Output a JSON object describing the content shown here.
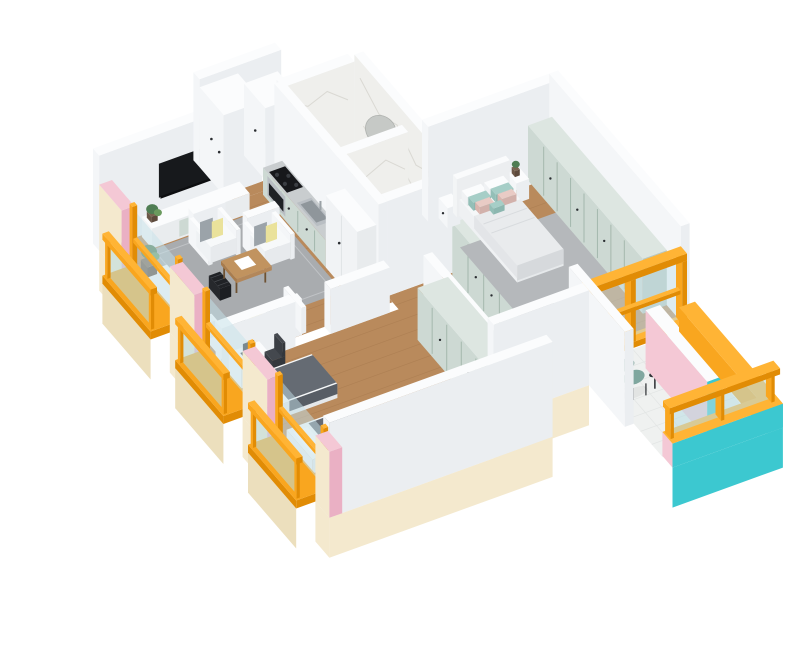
{
  "image_type": "isometric-3d-apartment-floor-plan-render",
  "palette": {
    "white": "#ffffff",
    "wall_top": "#fbfcfd",
    "wall_left": "#f4f6f8",
    "wall_front": "#ebeef1",
    "marble": "#efefec",
    "marble_vein": "#d7d6d0",
    "marble_floor": "#f3f2ef",
    "wood": "#b98a5c",
    "wood_line": "#9c6f45",
    "rug": "#a9acaf",
    "rug_border": "#c0c3c6",
    "cream": "#f4e9ce",
    "cream_dark": "#ecdfbd",
    "pink": "#f4c8d5",
    "pink_dark": "#eab0c4",
    "orange": "#f9a61f",
    "orange_light": "#ffb435",
    "orange_dark": "#e18c05",
    "teal": "#3cc8d0",
    "sage": "#cdd9d3",
    "sage_side": "#b9c8c1",
    "sage_top": "#dde6e1",
    "sage_line": "#a4b8ad",
    "glass": "rgba(197,226,233,0.50)",
    "glass_rail": "rgba(184,220,228,0.55)",
    "tv": "#17191c",
    "dark": "#2a2d31",
    "counter_top": "#c9cdcf",
    "steel": "#b9bec3",
    "steel_dark": "#8f969b",
    "duvet": "#e9ebed",
    "duvet_shade": "#d6d9dc",
    "blanket": "#656b73",
    "blanket_dark": "#575d65",
    "pillow_yellow": "#eae29b",
    "pillow_gray": "#9ba3a9",
    "pillow_teal": "#a6cec7",
    "pillow_teal_side": "#93bfb7",
    "pillow_pink": "#e9cbc5",
    "pillow_pink_side": "#dab5ae",
    "green": "#4f7d53",
    "green_light": "#6a9a5e",
    "pot": "#6b5747",
    "chair_teal": "#7fa79f",
    "chair_teal_dark": "#6e968e",
    "basin_wood": "#c9a377",
    "basin_wood_top": "#d4ad7f",
    "basin_wood_side": "#b98f60"
  },
  "scene": {
    "rooms": [
      {
        "name": "living-room",
        "floor": "wood",
        "furniture": [
          "wall-mounted-tv",
          "tv-stand-with-plants",
          "armchair-1",
          "armchair-2",
          "coffee-table-with-papers",
          "magazine-rack",
          "gray-rug",
          "corner-sofa",
          "floor-plant"
        ]
      },
      {
        "name": "kitchen",
        "floor": "wood",
        "furniture": [
          "sage-base-cabinets",
          "gray-countertop",
          "black-cooktop",
          "oven",
          "steel-sink",
          "tall-white-cabinet"
        ]
      },
      {
        "name": "hallway",
        "floor": "wood",
        "furniture": [
          "white-built-in-wardrobe-1",
          "white-built-in-wardrobe-2"
        ]
      },
      {
        "name": "bathroom-1",
        "floor": "marble",
        "furniture": [
          "washing-machine",
          "round-mirror",
          "wood-vanity-with-basin",
          "black-floor-lamp"
        ]
      },
      {
        "name": "bathroom-2",
        "floor": "marble",
        "furniture": [
          "round-mirror",
          "wood-vanity-with-basin",
          "black-floor-lamp"
        ]
      },
      {
        "name": "corridor",
        "floor": "wood",
        "furniture": [
          "sage-built-in-closet"
        ]
      },
      {
        "name": "master-bedroom",
        "floor": "wood",
        "furniture": [
          "double-bed-white-duvet",
          "headboard",
          "pink-pillows",
          "teal-pillows",
          "nightstand-left",
          "nightstand-right",
          "plant",
          "gray-rug",
          "sage-wardrobe-wall"
        ]
      },
      {
        "name": "second-bedroom",
        "floor": "wood",
        "furniture": [
          "single-bed-1-dark-blanket",
          "single-bed-2-dark-blanket",
          "desk-with-laptop",
          "dark-chair",
          "sage-wardrobe"
        ]
      },
      {
        "name": "left-balconies",
        "floor": "orange-decks",
        "furniture": [
          "glass-railings-orange-handrails",
          "orange-window-frames",
          "cream-facade",
          "pink-wall-cuts"
        ]
      },
      {
        "name": "terrace",
        "floor": "white-tile",
        "furniture": [
          "teal-armchair",
          "black-side-table",
          "teal-facade",
          "orange-trim",
          "glass-railing",
          "pink-wall-cut"
        ]
      }
    ]
  }
}
